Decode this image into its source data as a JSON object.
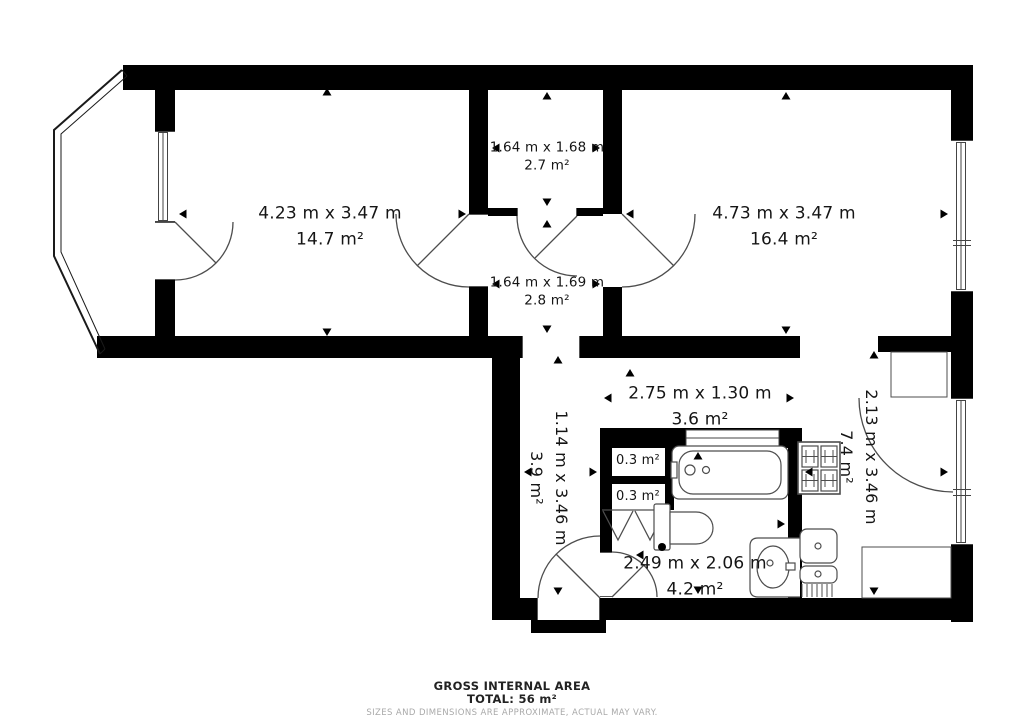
{
  "plan": {
    "rooms": [
      {
        "id": "bedroom-left",
        "dims": "4.23 m x 3.47 m",
        "area": "14.7 m²"
      },
      {
        "id": "storage-top",
        "dims": "1.64 m x 1.68 m",
        "area": "2.7 m²"
      },
      {
        "id": "inner-hall",
        "dims": "1.64 m x 1.69 m",
        "area": "2.8 m²"
      },
      {
        "id": "bedroom-right",
        "dims": "4.73 m x 3.47 m",
        "area": "16.4 m²"
      },
      {
        "id": "hallway",
        "dims": "2.75 m x 1.30 m",
        "area": "3.6 m²"
      },
      {
        "id": "hallway-lower",
        "dims": "1.14 m x 3.46 m",
        "area": "3.9 m²"
      },
      {
        "id": "kitchen",
        "dims": "2.13 m x 3.46 m",
        "area": "7.4 m²"
      },
      {
        "id": "bathroom",
        "dims": "2.49 m x 2.06 m",
        "area": "4.2 m²"
      },
      {
        "id": "closet-1",
        "area": "0.3 m²"
      },
      {
        "id": "closet-2",
        "area": "0.3 m²"
      }
    ],
    "footer": {
      "line1": "GROSS INTERNAL AREA",
      "line2": "TOTAL: 56 m²",
      "line3": "SIZES AND DIMENSIONS ARE APPROXIMATE, ACTUAL MAY VARY."
    },
    "colors": {
      "wall": "#000000",
      "fixture_line": "#4d4d4d",
      "text": "#151515",
      "muted": "#a9a9a9"
    }
  }
}
